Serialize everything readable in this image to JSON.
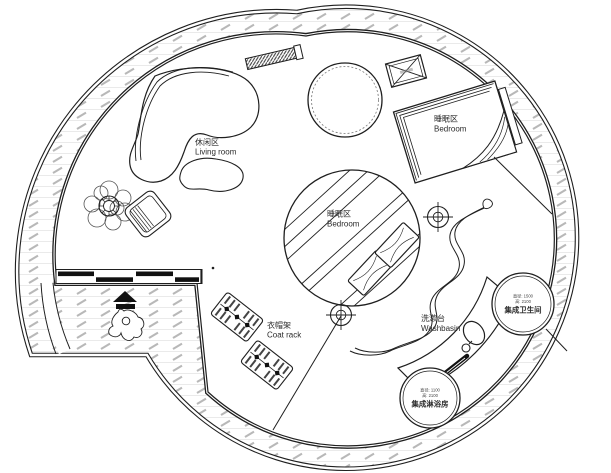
{
  "plan": {
    "type": "circular-house-floor-plan",
    "colors": {
      "line": "#1f1f1f",
      "hatch": "#b8b8b8",
      "hatch_row": "#e3e3e3",
      "floor": "#ffffff"
    },
    "labels": {
      "living_room": {
        "zh": "休闲区",
        "en": "Living room"
      },
      "bedroom_upper": {
        "zh": "睡眠区",
        "en": "Bedroom"
      },
      "bedroom_center": {
        "zh": "睡眠区",
        "en": "Bedroom"
      },
      "coat_rack": {
        "zh": "衣帽架",
        "en": "Coat rack"
      },
      "washbasin": {
        "zh": "洗漱台",
        "en": "Washbasin"
      },
      "bathroom_unit": {
        "name": "集成卫生间",
        "spec1": "直径: 1500",
        "spec2": "高: 2100"
      },
      "shower_unit": {
        "name": "集成淋浴房",
        "spec1": "直径: 1100",
        "spec2": "高: 2100"
      }
    }
  }
}
